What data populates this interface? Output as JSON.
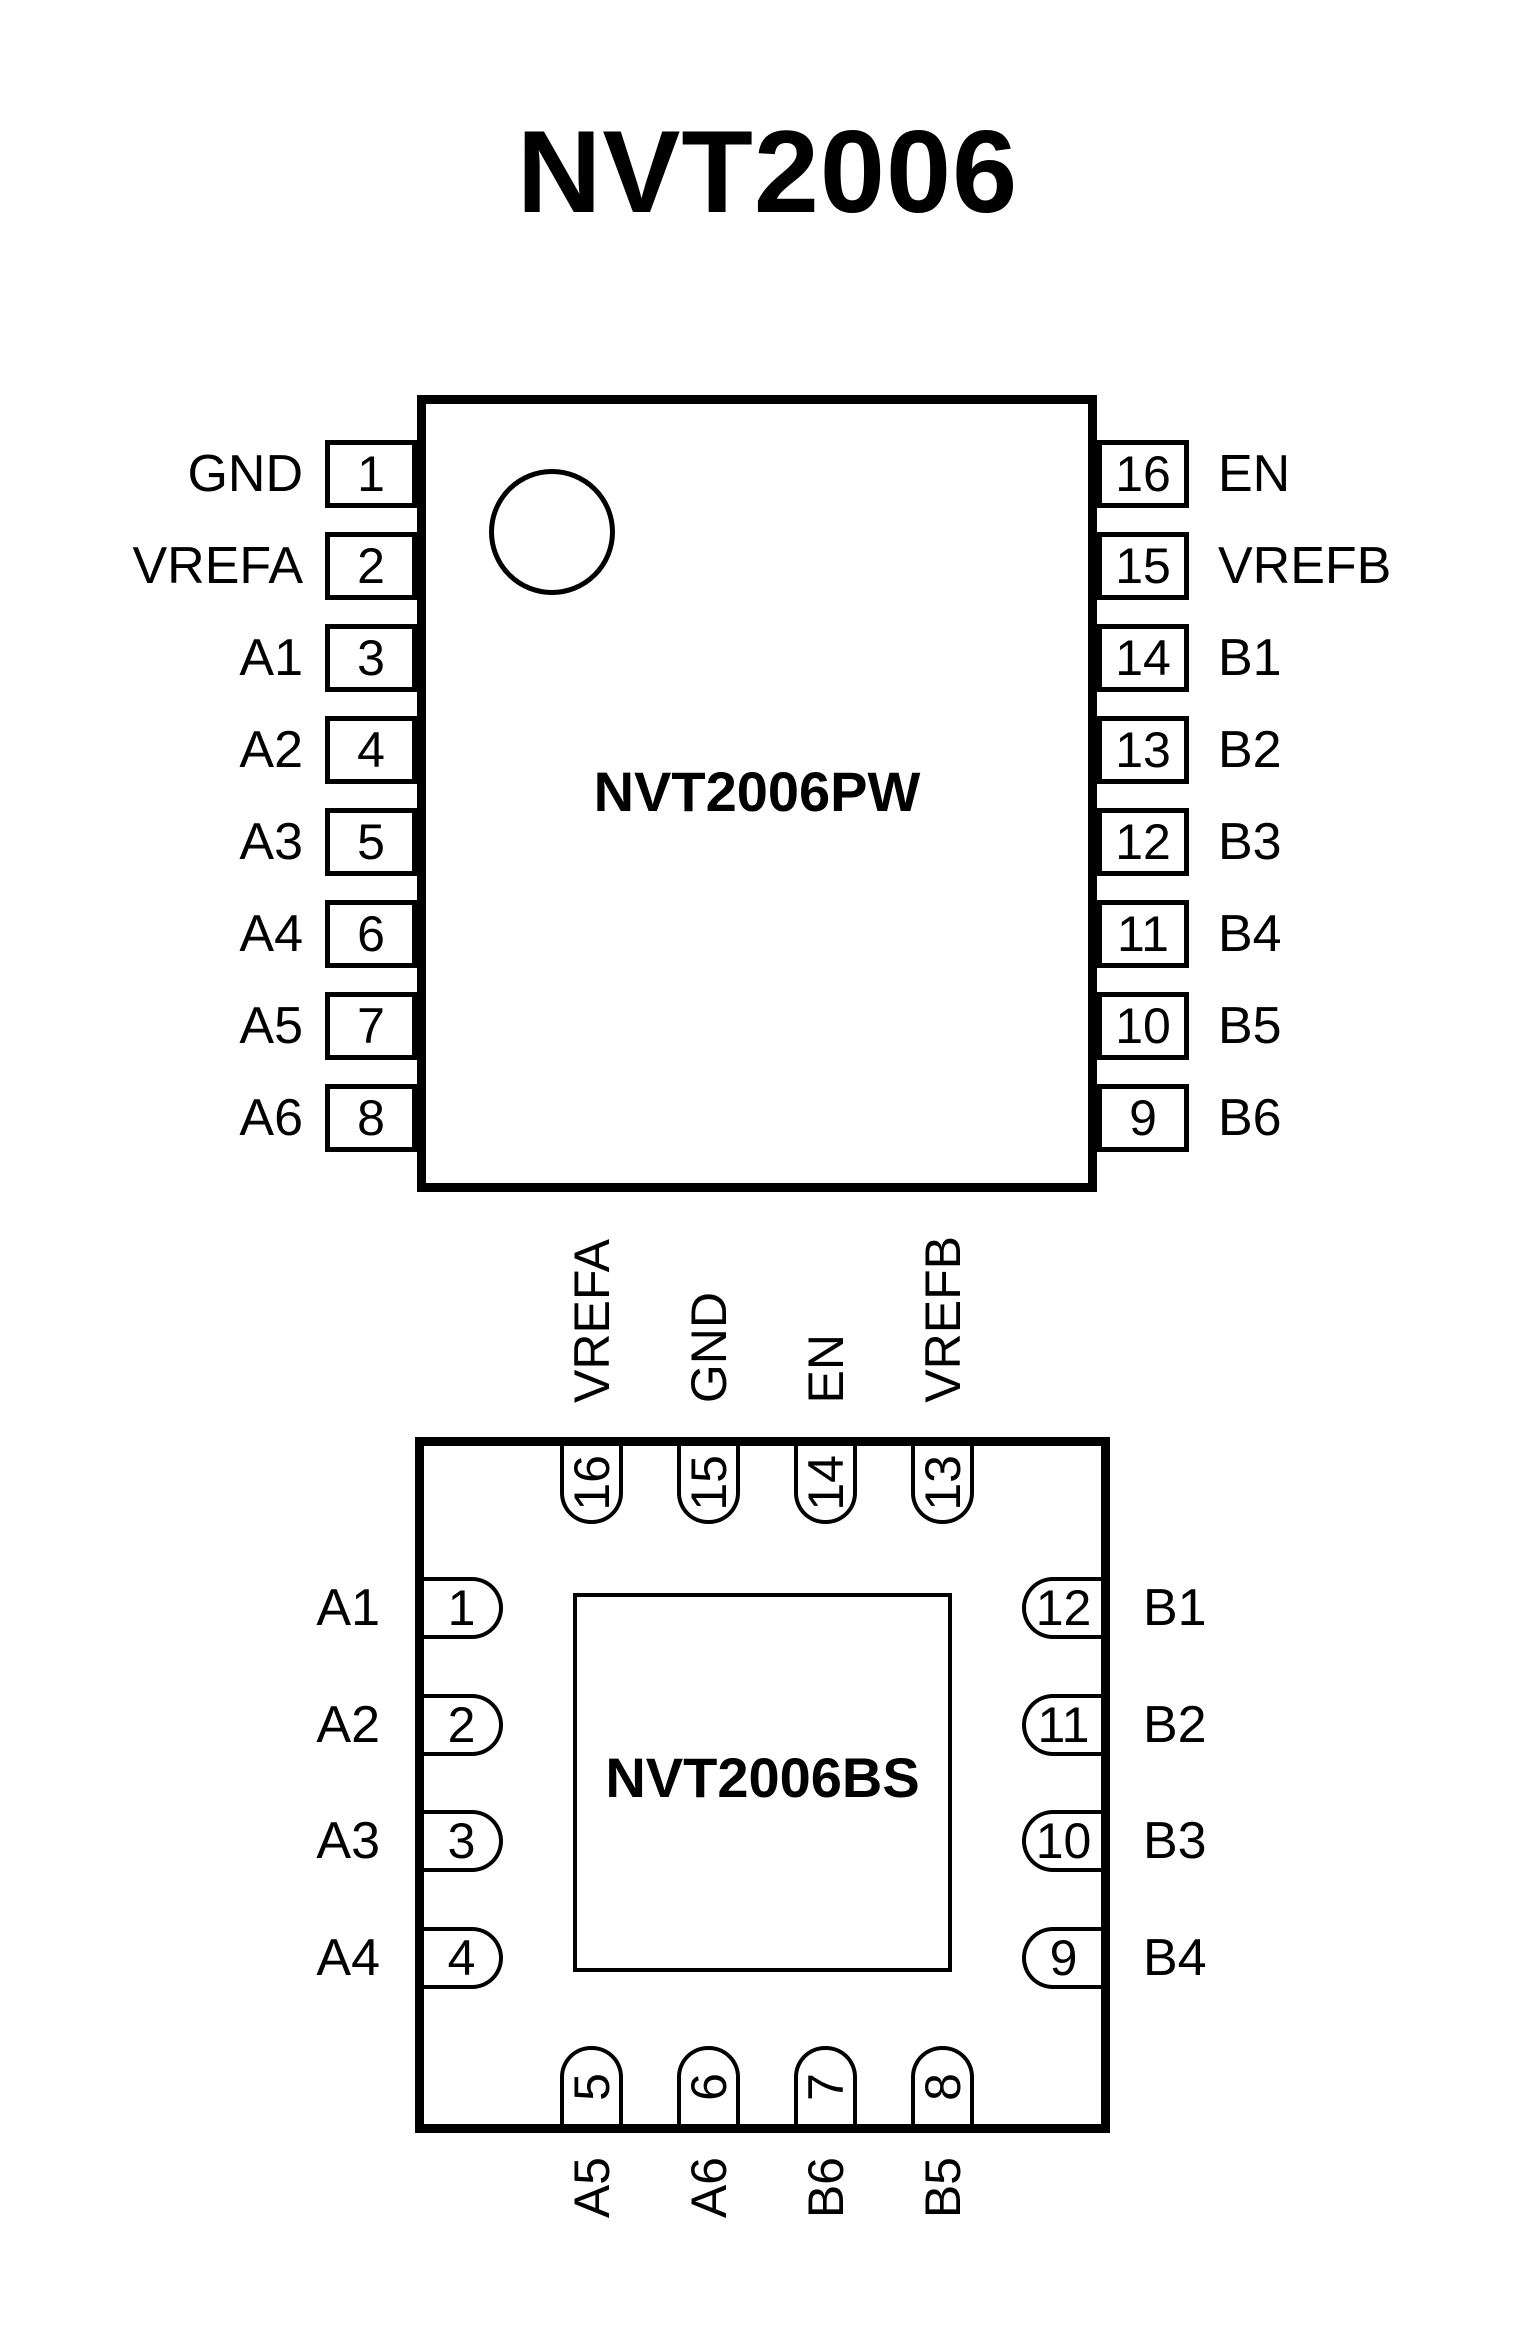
{
  "title": "NVT2006",
  "pw": {
    "part_label": "NVT2006PW",
    "left_pins": [
      {
        "num": "1",
        "label": "GND"
      },
      {
        "num": "2",
        "label": "VREFA"
      },
      {
        "num": "3",
        "label": "A1"
      },
      {
        "num": "4",
        "label": "A2"
      },
      {
        "num": "5",
        "label": "A3"
      },
      {
        "num": "6",
        "label": "A4"
      },
      {
        "num": "7",
        "label": "A5"
      },
      {
        "num": "8",
        "label": "A6"
      }
    ],
    "right_pins": [
      {
        "num": "16",
        "label": "EN"
      },
      {
        "num": "15",
        "label": "VREFB"
      },
      {
        "num": "14",
        "label": "B1"
      },
      {
        "num": "13",
        "label": "B2"
      },
      {
        "num": "12",
        "label": "B3"
      },
      {
        "num": "11",
        "label": "B4"
      },
      {
        "num": "10",
        "label": "B5"
      },
      {
        "num": "9",
        "label": "B6"
      }
    ]
  },
  "bs": {
    "part_label": "NVT2006BS",
    "top_pins": [
      {
        "num": "16",
        "label": "VREFA"
      },
      {
        "num": "15",
        "label": "GND"
      },
      {
        "num": "14",
        "label": "EN"
      },
      {
        "num": "13",
        "label": "VREFB"
      }
    ],
    "left_pins": [
      {
        "num": "1",
        "label": "A1"
      },
      {
        "num": "2",
        "label": "A2"
      },
      {
        "num": "3",
        "label": "A3"
      },
      {
        "num": "4",
        "label": "A4"
      }
    ],
    "right_pins": [
      {
        "num": "12",
        "label": "B1"
      },
      {
        "num": "11",
        "label": "B2"
      },
      {
        "num": "10",
        "label": "B3"
      },
      {
        "num": "9",
        "label": "B4"
      }
    ],
    "bottom_pins": [
      {
        "num": "5",
        "label": "A5"
      },
      {
        "num": "6",
        "label": "A6"
      },
      {
        "num": "7",
        "label": "B6"
      },
      {
        "num": "8",
        "label": "B5"
      }
    ]
  }
}
